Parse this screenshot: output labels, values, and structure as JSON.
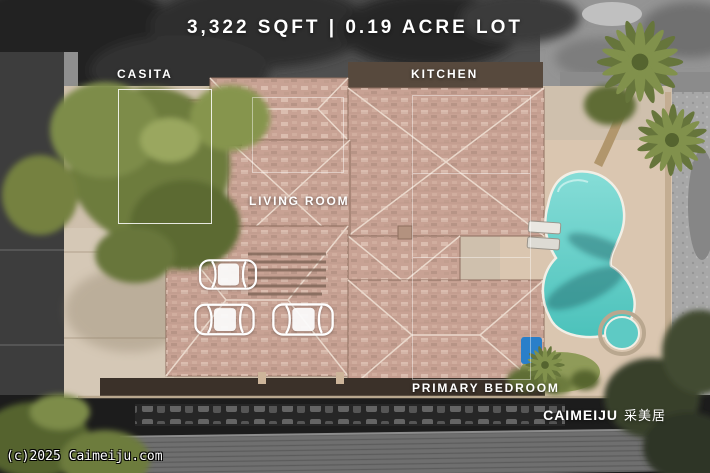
{
  "overlay": {
    "title": "3,322 SQFT | 0.19 ACRE LOT",
    "rooms": [
      {
        "id": "casita",
        "label": "CASITA"
      },
      {
        "id": "kitchen",
        "label": "KITCHEN"
      },
      {
        "id": "living_room",
        "label": "LIVING ROOM"
      },
      {
        "id": "primary_bedroom",
        "label": "PRIMARY BEDROOM"
      }
    ],
    "garage": {
      "car_outline_count": 3
    },
    "watermark": {
      "brand": "CAIMEIJU",
      "brand_cn": "采美居"
    },
    "copyright": "(c)2025 Caimeiju.com"
  },
  "scene": {
    "type": "aerial-photo",
    "subject": "single-story home with casita, three-car garage and pool; property in color over desaturated surroundings",
    "colors": {
      "annotation_text": "#ffffff",
      "roof_tile": "#c8a294",
      "roof_ridge": "#ead8cb",
      "driveway": "#d5c8b6",
      "pool_water": "#5ecac4",
      "pool_deck": "#dac6b0",
      "foliage": "#6d7b3d",
      "street_gray": "#3d3d3d",
      "desaturated_surround": "#8f8f8f"
    }
  }
}
